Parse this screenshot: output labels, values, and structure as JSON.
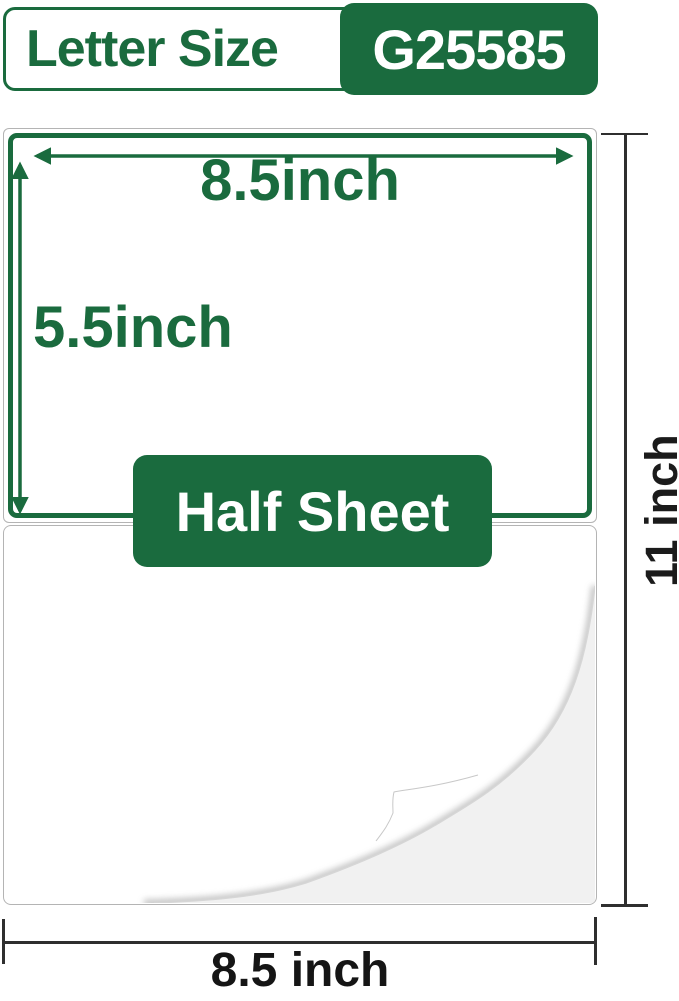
{
  "header": {
    "title": "Letter Size",
    "code": "G25585"
  },
  "diagram": {
    "label_width": "8.5inch",
    "label_height": "5.5inch",
    "half_sheet_badge": "Half Sheet",
    "page_height": "11 inch",
    "page_width": "8.5 inch"
  },
  "colors": {
    "brand_green": "#1a6b3e",
    "text_ink": "#1b1b1b",
    "dimension_line": "#2f2f2f",
    "sheet_border": "#b4b4b4",
    "curl_underside": "#f1f1f1"
  }
}
